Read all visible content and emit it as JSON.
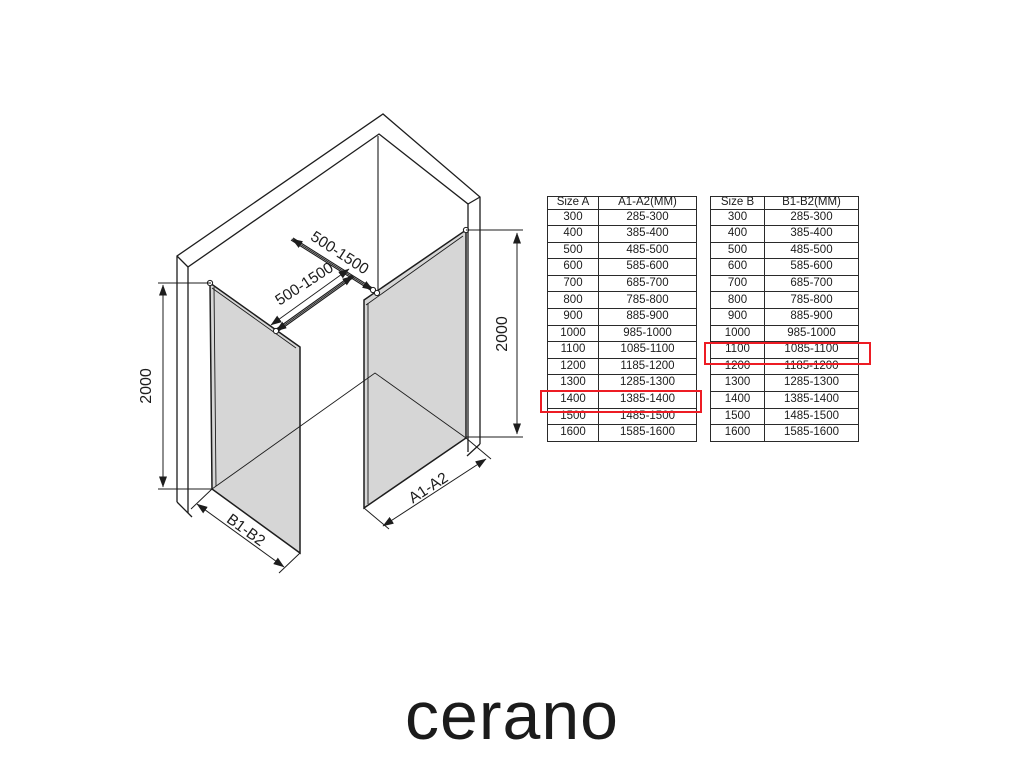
{
  "brand": {
    "logo_text": "cerano"
  },
  "diagram": {
    "height_label": "2000",
    "bar_length_label": "500-1500",
    "left_width_label": "B1-B2",
    "right_width_label": "A1-A2"
  },
  "colors": {
    "accent_red": "#ed1c24",
    "glass_gray": "#d6d6d6",
    "line_black": "#1d1d1d"
  },
  "tables": {
    "a": {
      "headers": [
        "Size A",
        "A1-A2(MM)"
      ],
      "rows": [
        [
          "300",
          "285-300"
        ],
        [
          "400",
          "385-400"
        ],
        [
          "500",
          "485-500"
        ],
        [
          "600",
          "585-600"
        ],
        [
          "700",
          "685-700"
        ],
        [
          "800",
          "785-800"
        ],
        [
          "900",
          "885-900"
        ],
        [
          "1000",
          "985-1000"
        ],
        [
          "1100",
          "1085-1100"
        ],
        [
          "1200",
          "1185-1200"
        ],
        [
          "1300",
          "1285-1300"
        ],
        [
          "1400",
          "1385-1400"
        ],
        [
          "1500",
          "1485-1500"
        ],
        [
          "1600",
          "1585-1600"
        ]
      ],
      "highlighted_size": "1400",
      "highlighted_range": "1385-1400"
    },
    "b": {
      "headers": [
        "Size B",
        "B1-B2(MM)"
      ],
      "rows": [
        [
          "300",
          "285-300"
        ],
        [
          "400",
          "385-400"
        ],
        [
          "500",
          "485-500"
        ],
        [
          "600",
          "585-600"
        ],
        [
          "700",
          "685-700"
        ],
        [
          "800",
          "785-800"
        ],
        [
          "900",
          "885-900"
        ],
        [
          "1000",
          "985-1000"
        ],
        [
          "1100",
          "1085-1100"
        ],
        [
          "1200",
          "1185-1200"
        ],
        [
          "1300",
          "1285-1300"
        ],
        [
          "1400",
          "1385-1400"
        ],
        [
          "1500",
          "1485-1500"
        ],
        [
          "1600",
          "1585-1600"
        ]
      ],
      "highlighted_size": "1100",
      "highlighted_range": "1085-1100"
    }
  }
}
